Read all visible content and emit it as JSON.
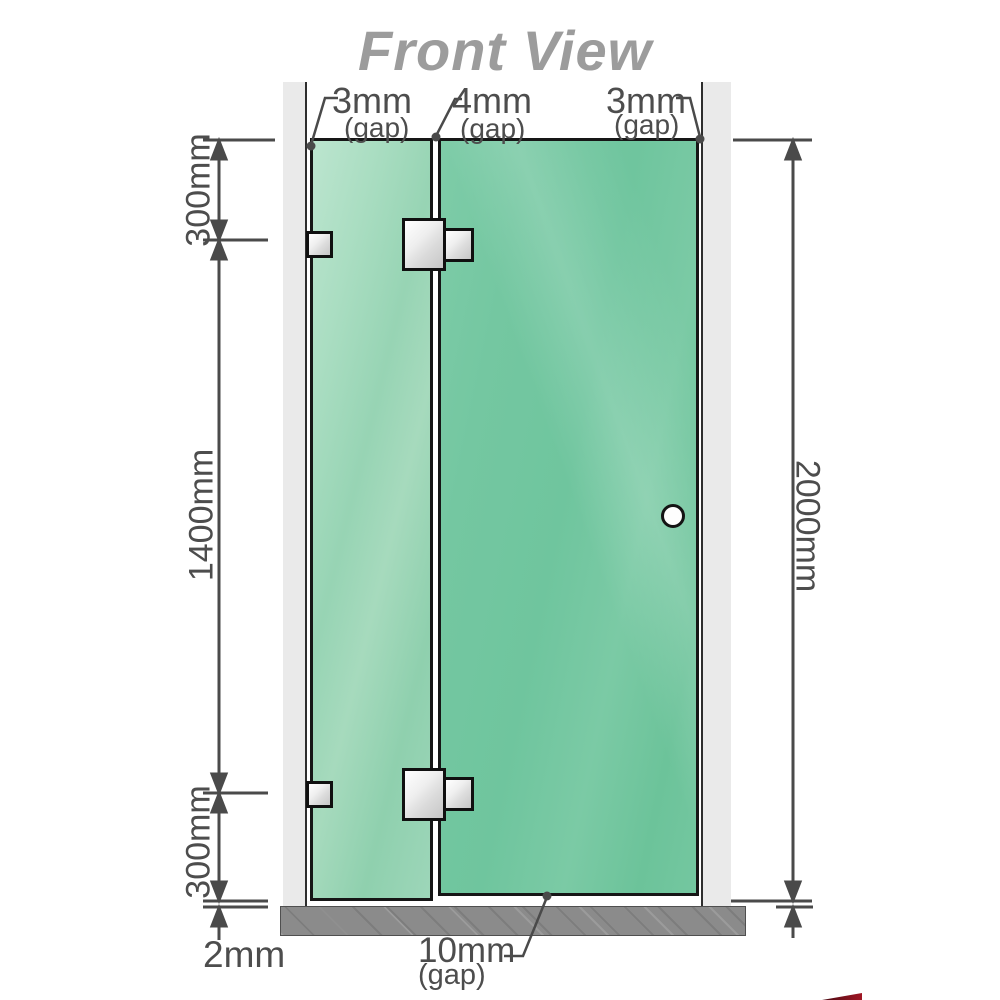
{
  "title": "Front View",
  "gaps": {
    "left_wall": "3mm",
    "between_panels": "4mm",
    "right_wall": "3mm",
    "floor": "10mm",
    "suffix": "(gap)"
  },
  "dimensions": {
    "left_top": "300mm",
    "left_middle": "1400mm",
    "left_bottom": "300mm",
    "right_total": "2000mm",
    "base_thickness": "2mm"
  },
  "components": {
    "left_wall": "wall",
    "right_wall": "wall",
    "fixed_panel": "glass panel",
    "door_panel": "hinged glass door",
    "hardware": [
      "wall bracket top",
      "wall bracket bottom",
      "glass hinge top",
      "glass hinge bottom",
      "door knob"
    ],
    "base": "floor base bar"
  },
  "colors": {
    "glass_fixed": "#a5dabd",
    "glass_door": "#74c7a1",
    "wall": "#eaeaea",
    "base": "#8b8b8b",
    "outline": "#161616",
    "dimension": "#4d4d4d",
    "title": "#9c9c9c",
    "hardware": "#e8e8e8",
    "knob": "#fefefe",
    "logo_red": "#a01624"
  }
}
